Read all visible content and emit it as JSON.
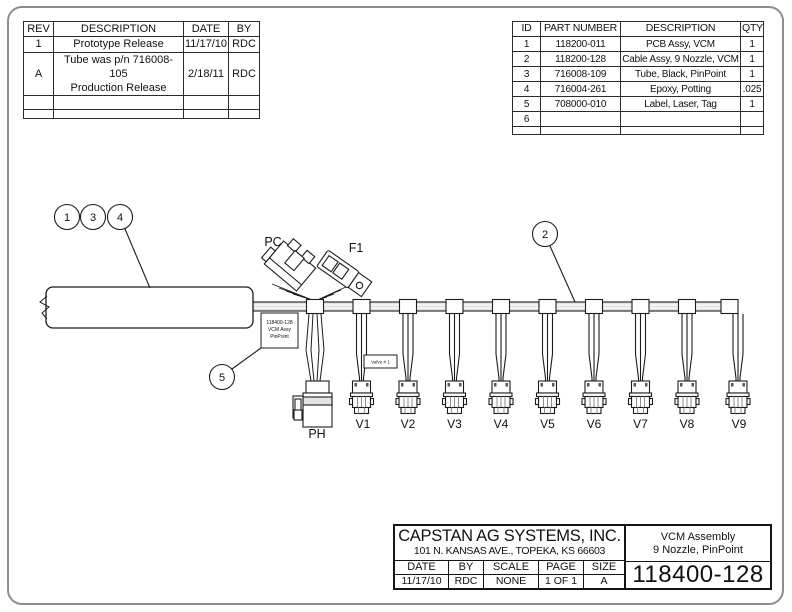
{
  "rev_table": {
    "headers": [
      "REV",
      "DESCRIPTION",
      "DATE",
      "BY"
    ],
    "rows": [
      {
        "rev": "1",
        "desc": "Prototype Release",
        "date": "11/17/10",
        "by": "RDC"
      },
      {
        "rev": "A",
        "desc": "Tube was p/n 716008-105\nProduction Release",
        "date": "2/18/11",
        "by": "RDC"
      },
      {
        "rev": "",
        "desc": "",
        "date": "",
        "by": ""
      },
      {
        "rev": "",
        "desc": "",
        "date": "",
        "by": ""
      }
    ]
  },
  "parts_table": {
    "headers": [
      "ID",
      "PART NUMBER",
      "DESCRIPTION",
      "QTY"
    ],
    "rows": [
      {
        "id": "1",
        "pn": "118200-011",
        "desc": "PCB Assy, VCM",
        "qty": "1"
      },
      {
        "id": "2",
        "pn": "118200-128",
        "desc": "Cable Assy, 9 Nozzle, VCM",
        "qty": "1"
      },
      {
        "id": "3",
        "pn": "716008-109",
        "desc": "Tube, Black, PinPoint",
        "qty": "1"
      },
      {
        "id": "4",
        "pn": "716004-261",
        "desc": "Epoxy, Potting",
        "qty": ".025"
      },
      {
        "id": "5",
        "pn": "708000-010",
        "desc": "Label, Laser, Tag",
        "qty": "1"
      },
      {
        "id": "6",
        "pn": "",
        "desc": "",
        "qty": ""
      },
      {
        "id": "",
        "pn": "",
        "desc": "",
        "qty": ""
      }
    ]
  },
  "drawing": {
    "balloons": {
      "b1": "1",
      "b3": "3",
      "b4": "4",
      "b2": "2",
      "b5": "5"
    },
    "labels": {
      "pc": "PC",
      "f1": "F1",
      "ph": "PH"
    },
    "valves": [
      "V1",
      "V2",
      "V3",
      "V4",
      "V5",
      "V6",
      "V7",
      "V8",
      "V9"
    ],
    "assembly_tag": {
      "line1": "118400-128",
      "line2": "VCM Assy",
      "line3": "PinPoint"
    },
    "valve_tag": "Valve # 1"
  },
  "title_block": {
    "company_name": "CAPSTAN AG SYSTEMS, INC.",
    "company_address": "101 N. KANSAS AVE., TOPEKA, KS 66603",
    "field_headers": [
      "DATE",
      "BY",
      "SCALE",
      "PAGE",
      "SIZE"
    ],
    "field_values": [
      "11/17/10",
      "RDC",
      "NONE",
      "1 OF 1",
      "A"
    ],
    "title_line1": "VCM Assembly",
    "title_line2": "9 Nozzle, PinPoint",
    "drawing_number": "118400-128"
  },
  "colors": {
    "line": "#1c1c1c",
    "sheet_border": "#8d8d8d",
    "cable_fill": "#e4e4e4"
  }
}
